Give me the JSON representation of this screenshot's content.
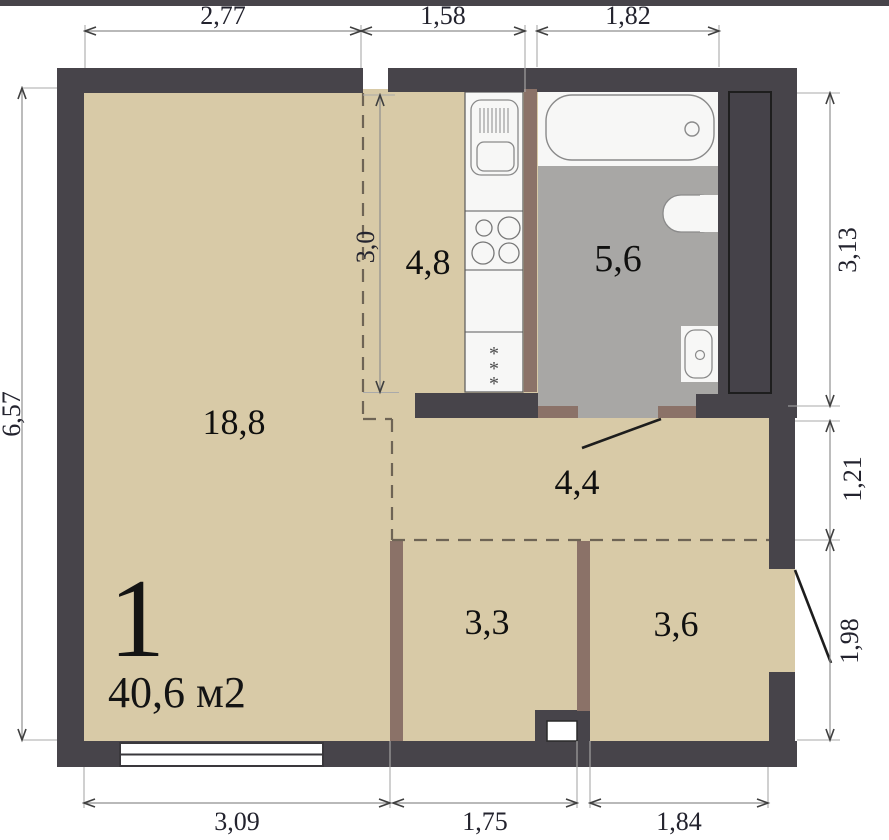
{
  "plan": {
    "unit_label": "1",
    "unit_area": "40,6 м2",
    "room_areas": {
      "living": "18,8",
      "kitchen": "4,8",
      "bathroom": "5,6",
      "hallway": "4,4",
      "room_left": "3,3",
      "room_right": "3,6"
    },
    "dimensions": {
      "top": [
        "2,77",
        "1,58",
        "1,82"
      ],
      "right": [
        "3,13",
        "1,21",
        "1,98"
      ],
      "bottom": [
        "3,09",
        "1,75",
        "1,84"
      ],
      "left": "6,57",
      "kitchen_inner": "3,0"
    },
    "symbols": {
      "fridge_star": "*"
    },
    "colors": {
      "wall": "#47444a",
      "partition": "#8b7268",
      "floor": "#d8caa7",
      "bathroom_floor": "#a8a7a5",
      "fixture_white": "#f7f7f6",
      "dashed_line": "#6e6455",
      "dimension_line": "#9a9a9a",
      "dimension_text": "#23232e"
    }
  }
}
